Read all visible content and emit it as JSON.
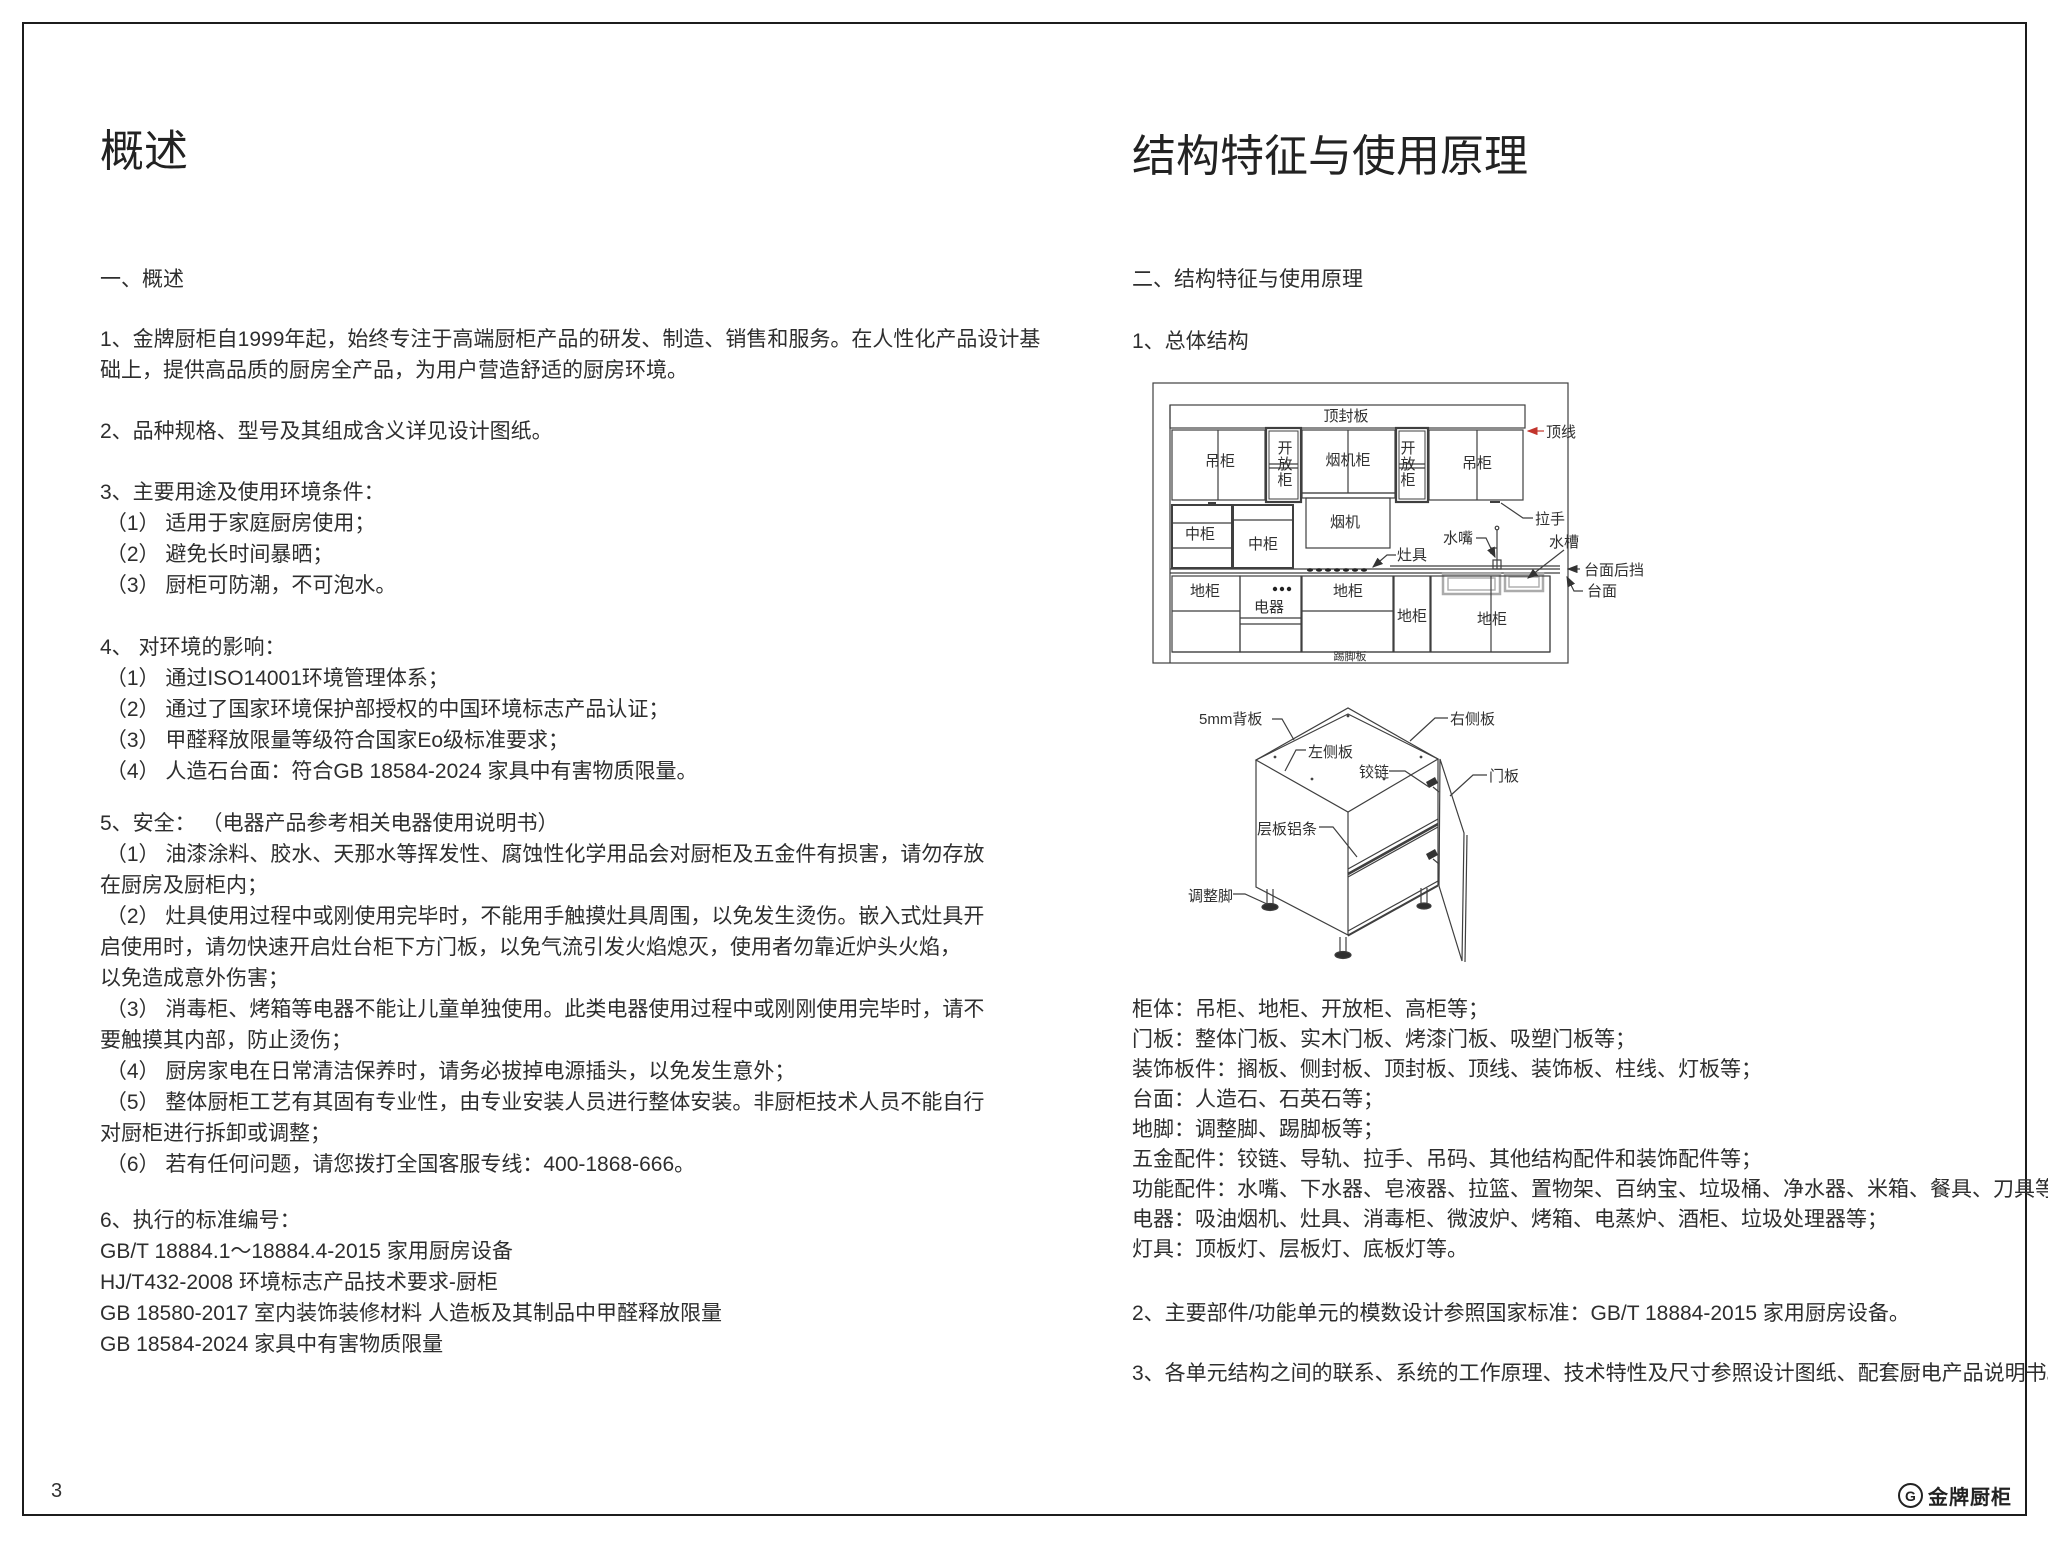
{
  "page": {
    "number": "3",
    "brand": "金牌厨柜",
    "brand_mark": "G"
  },
  "left": {
    "title": "概述",
    "groups": [
      [
        "一、概述"
      ],
      [
        "1、金牌厨柜自1999年起，始终专注于高端厨柜产品的研发、制造、销售和服务。在人性化产品设计基",
        "础上，提供高品质的厨房全产品，为用户营造舒适的厨房环境。"
      ],
      [
        "2、品种规格、型号及其组成含义详见设计图纸。"
      ],
      [
        "3、主要用途及使用环境条件：",
        " （1） 适用于家庭厨房使用；",
        " （2） 避免长时间暴晒；",
        " （3） 厨柜可防潮，不可泡水。"
      ],
      [
        "4、 对环境的影响：",
        " （1） 通过ISO14001环境管理体系；",
        " （2） 通过了国家环境保护部授权的中国环境标志产品认证；",
        " （3） 甲醛释放限量等级符合国家Eo级标准要求；",
        " （4） 人造石台面：符合GB 18584-2024 家具中有害物质限量。"
      ],
      [
        "5、安全： （电器产品参考相关电器使用说明书）",
        " （1） 油漆涂料、胶水、天那水等挥发性、腐蚀性化学用品会对厨柜及五金件有损害，请勿存放",
        "在厨房及厨柜内；",
        " （2） 灶具使用过程中或刚使用完毕时，不能用手触摸灶具周围，以免发生烫伤。嵌入式灶具开",
        "启使用时，请勿快速开启灶台柜下方门板，以免气流引发火焰熄灭，使用者勿靠近炉头火焰，",
        "以免造成意外伤害；",
        " （3） 消毒柜、烤箱等电器不能让儿童单独使用。此类电器使用过程中或刚刚使用完毕时，请不",
        "要触摸其内部，防止烫伤；",
        " （4） 厨房家电在日常清洁保养时，请务必拔掉电源插头，以免发生意外；",
        " （5） 整体厨柜工艺有其固有专业性，由专业安装人员进行整体安装。非厨柜技术人员不能自行",
        "对厨柜进行拆卸或调整；",
        " （6） 若有任何问题，请您拨打全国客服专线：400-1868-666。"
      ],
      [
        "6、执行的标准编号：",
        "GB/T 18884.1～18884.4-2015 家用厨房设备",
        "HJ/T432-2008 环境标志产品技术要求-厨柜",
        "GB 18580-2017 室内装饰装修材料 人造板及其制品中甲醛释放限量",
        "GB 18584-2024 家具中有害物质限量"
      ]
    ]
  },
  "right": {
    "title": "结构特征与使用原理",
    "heading": "二、结构特征与使用原理",
    "sub1": "1、总体结构",
    "kitchen": {
      "top_board": "顶封板",
      "top_line": "顶线",
      "wall_cab_left": "吊柜",
      "open_cab_left": "开放柜",
      "hood_cab": "烟机柜",
      "open_cab_right": "开放柜",
      "wall_cab_right": "吊柜",
      "handle": "拉手",
      "mid_cab_1": "中柜",
      "mid_cab_2": "中柜",
      "hood": "烟机",
      "faucet": "水嘴",
      "sink": "水槽",
      "stove": "灶具",
      "counter_back": "台面后挡",
      "counter": "台面",
      "base_1": "地柜",
      "appliance": "电器",
      "base_2": "地柜",
      "base_3": "地柜",
      "base_4": "地柜",
      "kick": "踢脚板"
    },
    "cabinet": {
      "back_panel": "5mm背板",
      "right_side": "右侧板",
      "left_side": "左侧板",
      "hinge": "铰链",
      "door": "门板",
      "shelf_strip": "层板铝条",
      "feet": "调整脚"
    },
    "component_lines": [
      "柜体：吊柜、地柜、开放柜、高柜等；",
      "门板：整体门板、实木门板、烤漆门板、吸塑门板等；",
      "装饰板件：搁板、侧封板、顶封板、顶线、装饰板、柱线、灯板等；",
      "台面：人造石、石英石等；",
      "地脚：调整脚、踢脚板等；",
      "五金配件：铰链、导轨、拉手、吊码、其他结构配件和装饰配件等；",
      "功能配件：水嘴、下水器、皂液器、拉篮、置物架、百纳宝、垃圾桶、净水器、米箱、餐具、刀具等；",
      "电器：吸油烟机、灶具、消毒柜、微波炉、烤箱、电蒸炉、酒柜、垃圾处理器等；",
      "灯具：顶板灯、层板灯、底板灯等。"
    ],
    "item2": "2、主要部件/功能单元的模数设计参照国家标准：GB/T 18884-2015 家用厨房设备。",
    "item3": "3、各单元结构之间的联系、系统的工作原理、技术特性及尺寸参照设计图纸、配套厨电产品说明书。"
  }
}
